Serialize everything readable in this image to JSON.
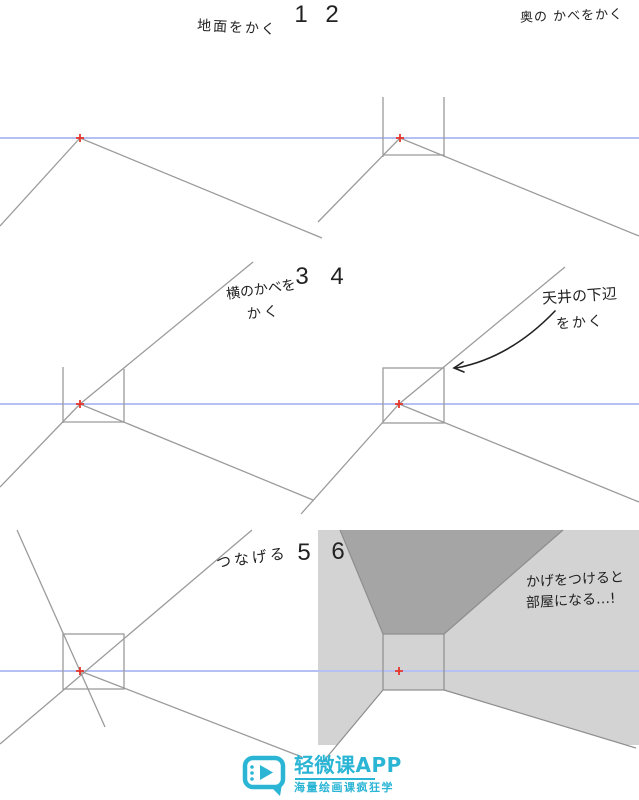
{
  "page": {
    "width": 639,
    "height": 800,
    "background": "#ffffff"
  },
  "colors": {
    "horizon_blue": "#b6c0f2",
    "line_gray": "#9b9b9b",
    "edge_gray": "#8e8e8e",
    "wall_light": "#d3d3d3",
    "ceiling_dark": "#a5a5a5",
    "floor_white": "#ffffff",
    "vp_red": "#e5362c",
    "ink": "#222222",
    "logo_cyan": "#2ab5d5"
  },
  "steps": [
    {
      "number": "1",
      "label": "地面をかく"
    },
    {
      "number": "2",
      "label": "奥の かべをかく"
    },
    {
      "number": "3",
      "label_line1": "横のかべを",
      "label_line2": "かく"
    },
    {
      "number": "4",
      "label_line1": "天井の下辺",
      "label_line2": "をかく"
    },
    {
      "number": "5",
      "label": "つなげる"
    },
    {
      "number": "6",
      "label_line1": "かげをつけると",
      "label_line2": "部屋になる…!"
    }
  ],
  "watermark": {
    "app_name": "轻微课APP",
    "tagline": "海量绘画课疯狂学"
  }
}
